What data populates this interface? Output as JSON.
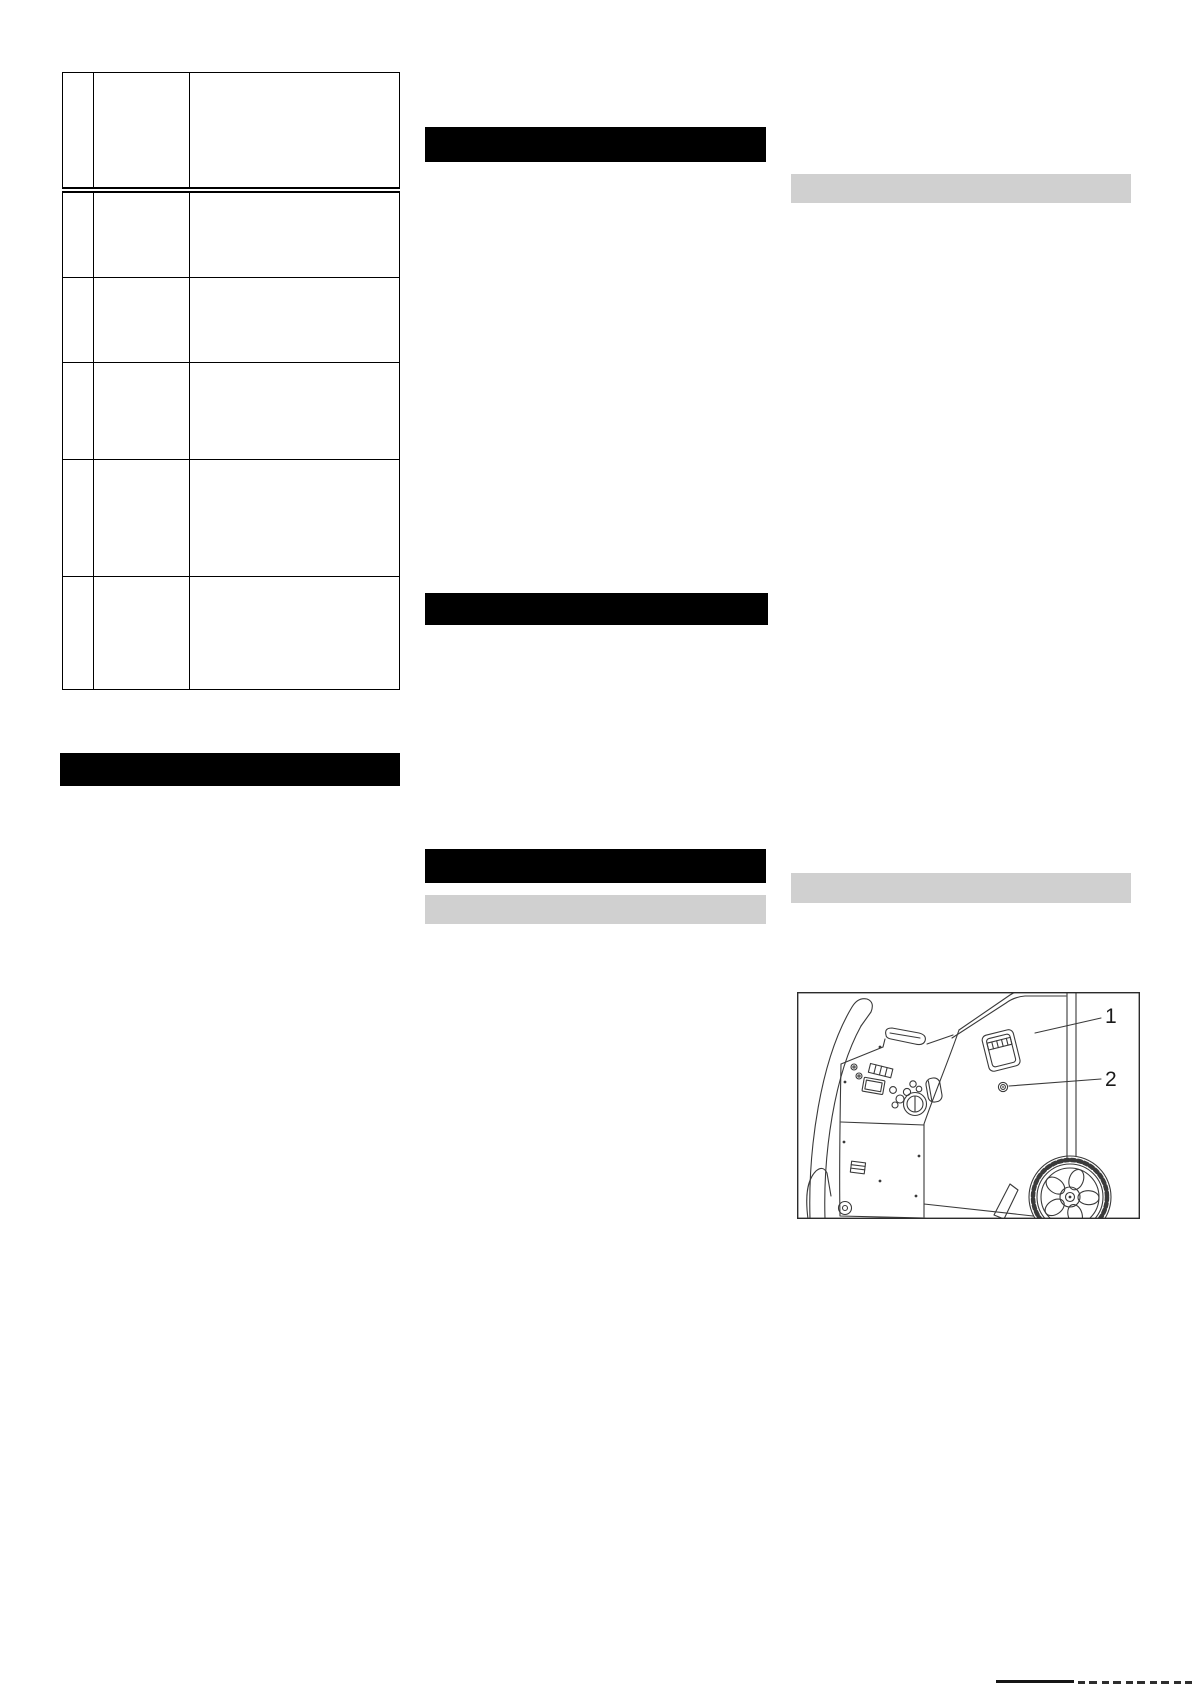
{
  "page": {
    "background": "#ffffff"
  },
  "colors": {
    "heading_bar": "#000000",
    "subheading_bar": "#d0d0d0",
    "table_border": "#000000",
    "line_art": "#3a3a3a",
    "callout_text": "#1a1a1a"
  },
  "table": {
    "columns": [
      "",
      "",
      ""
    ],
    "rows": [
      [
        "",
        "",
        ""
      ],
      [
        "",
        "",
        ""
      ],
      [
        "",
        "",
        ""
      ],
      [
        "",
        "",
        ""
      ],
      [
        "",
        "",
        ""
      ],
      [
        "",
        "",
        ""
      ]
    ]
  },
  "illustration": {
    "callouts": [
      {
        "label": "1"
      },
      {
        "label": "2"
      }
    ]
  }
}
